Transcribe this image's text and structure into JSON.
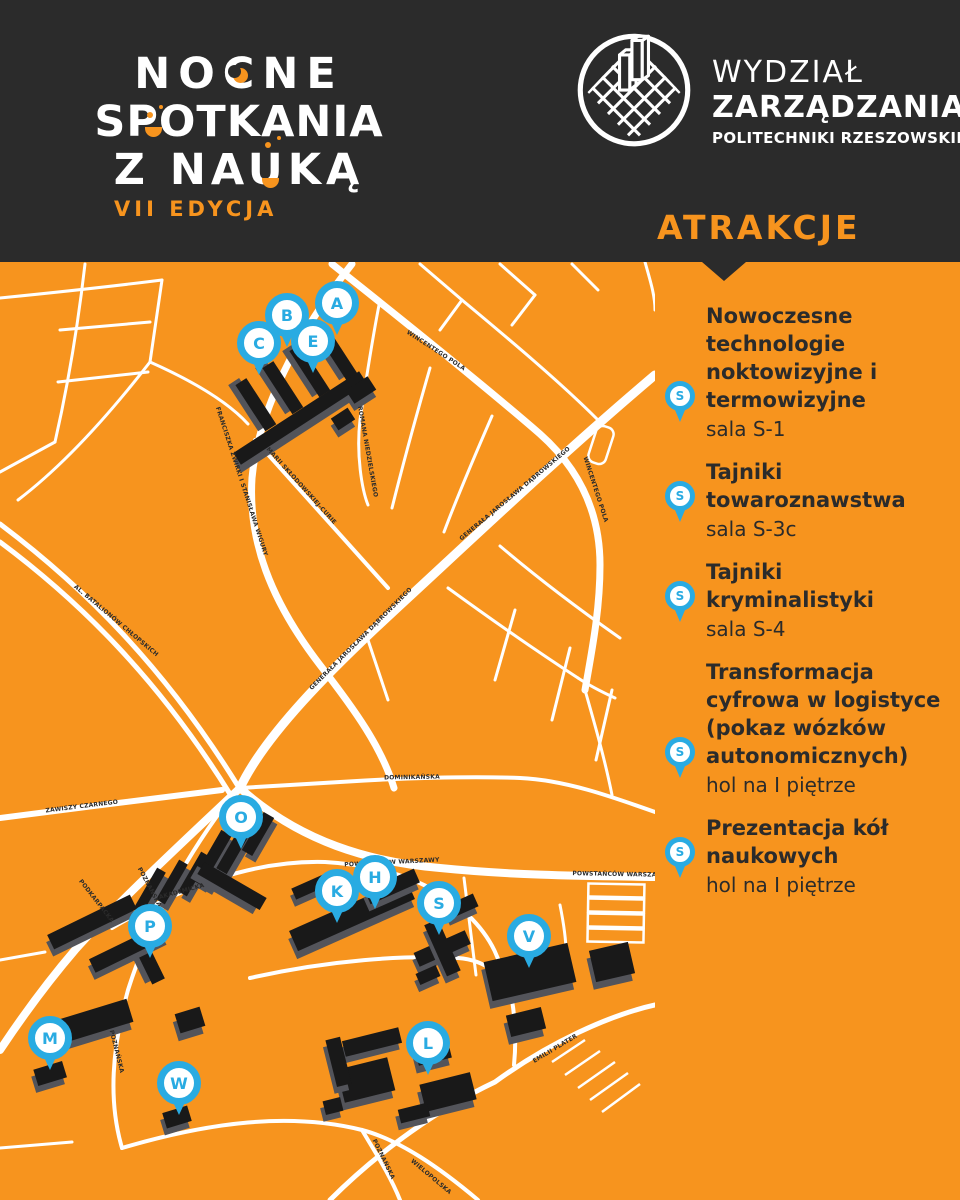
{
  "colors": {
    "orange": "#F7941E",
    "dark": "#2B2B2B",
    "blue": "#29ABE2",
    "building": "#191919",
    "road": "#FFFFFF"
  },
  "header": {
    "event_logo": {
      "line1": "NOCNE",
      "line2": "SPOTKANIA",
      "line3": "Z NAUKĄ",
      "edition": "VII EDYCJA"
    },
    "faculty_logo": {
      "line1": "WYDZIAŁ",
      "line2": "ZARZĄDZANIA",
      "line3": "POLITECHNIKI RZESZOWSKIEJ"
    }
  },
  "sidebar": {
    "title": "ATRAKCJE",
    "pin_letter": "S",
    "attractions": [
      {
        "title": "Nowoczesne technologie noktowizyjne i termowizyjne",
        "location": "sala S-1"
      },
      {
        "title": "Tajniki towaroznawstwa",
        "location": "sala S-3c"
      },
      {
        "title": "Tajniki kryminalistyki",
        "location": "sala S-4"
      },
      {
        "title": "Transformacja cyfrowa w logistyce (pokaz wózków autonomicznych)",
        "location": "hol na I piętrze"
      },
      {
        "title": "Prezentacja kół naukowych",
        "location": "hol na I piętrze"
      }
    ]
  },
  "map": {
    "markers": [
      {
        "letter": "A"
      },
      {
        "letter": "B"
      },
      {
        "letter": "C"
      },
      {
        "letter": "E"
      },
      {
        "letter": "O"
      },
      {
        "letter": "P"
      },
      {
        "letter": "K"
      },
      {
        "letter": "H"
      },
      {
        "letter": "S"
      },
      {
        "letter": "V"
      },
      {
        "letter": "M"
      },
      {
        "letter": "W"
      },
      {
        "letter": "L"
      }
    ],
    "street_labels": [
      {
        "text": "FRANCISZKA ŻWIRKI I STANISŁAWA WIGURY"
      },
      {
        "text": "MARII SKŁODOWSKIEJ-CURIE"
      },
      {
        "text": "ROMANA NIEDZIELSKIEGO"
      },
      {
        "text": "WINCENTEGO POLA"
      },
      {
        "text": "WINCENTEGO POLA"
      },
      {
        "text": "GENERAŁA JAROSŁAWA DĄBROWSKIEGO"
      },
      {
        "text": "GENERAŁA JAROSŁAWA DĄBROWSKIEGO"
      },
      {
        "text": "AL. BATALIONÓW CHŁOPSKICH"
      },
      {
        "text": "ZAWISZY CZARNEGO"
      },
      {
        "text": "PODKARPACKA"
      },
      {
        "text": "POZNAŃSKA"
      },
      {
        "text": "AKADEMICKA"
      },
      {
        "text": "POWSTAŃCÓW WARSZAWY"
      },
      {
        "text": "POWSTAŃCÓW WARSZAWY"
      },
      {
        "text": "DOMINIKAŃSKA"
      },
      {
        "text": "POZNAŃSKA"
      },
      {
        "text": "POZNAŃSKA"
      },
      {
        "text": "WIELOPOLSKA"
      },
      {
        "text": "EMILII PLATER"
      }
    ]
  }
}
